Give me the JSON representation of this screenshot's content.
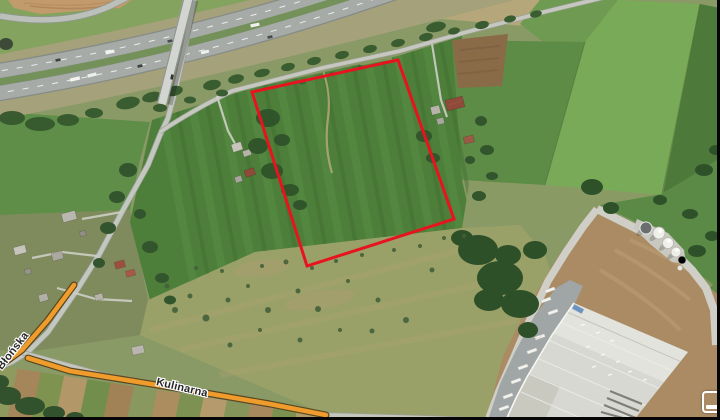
{
  "map": {
    "view_type": "satellite",
    "road_labels": [
      {
        "name": "Błońska"
      },
      {
        "name": "Kulinarna"
      }
    ],
    "highlight_road_color": "#f09c2c",
    "parcel_outline": {
      "points": "398,60 252,92 307,266 454,219",
      "color": "#e7131e",
      "stroke_width": "3"
    },
    "controls": {
      "corner_button_icon": "partial-rounded-rect-button"
    }
  }
}
